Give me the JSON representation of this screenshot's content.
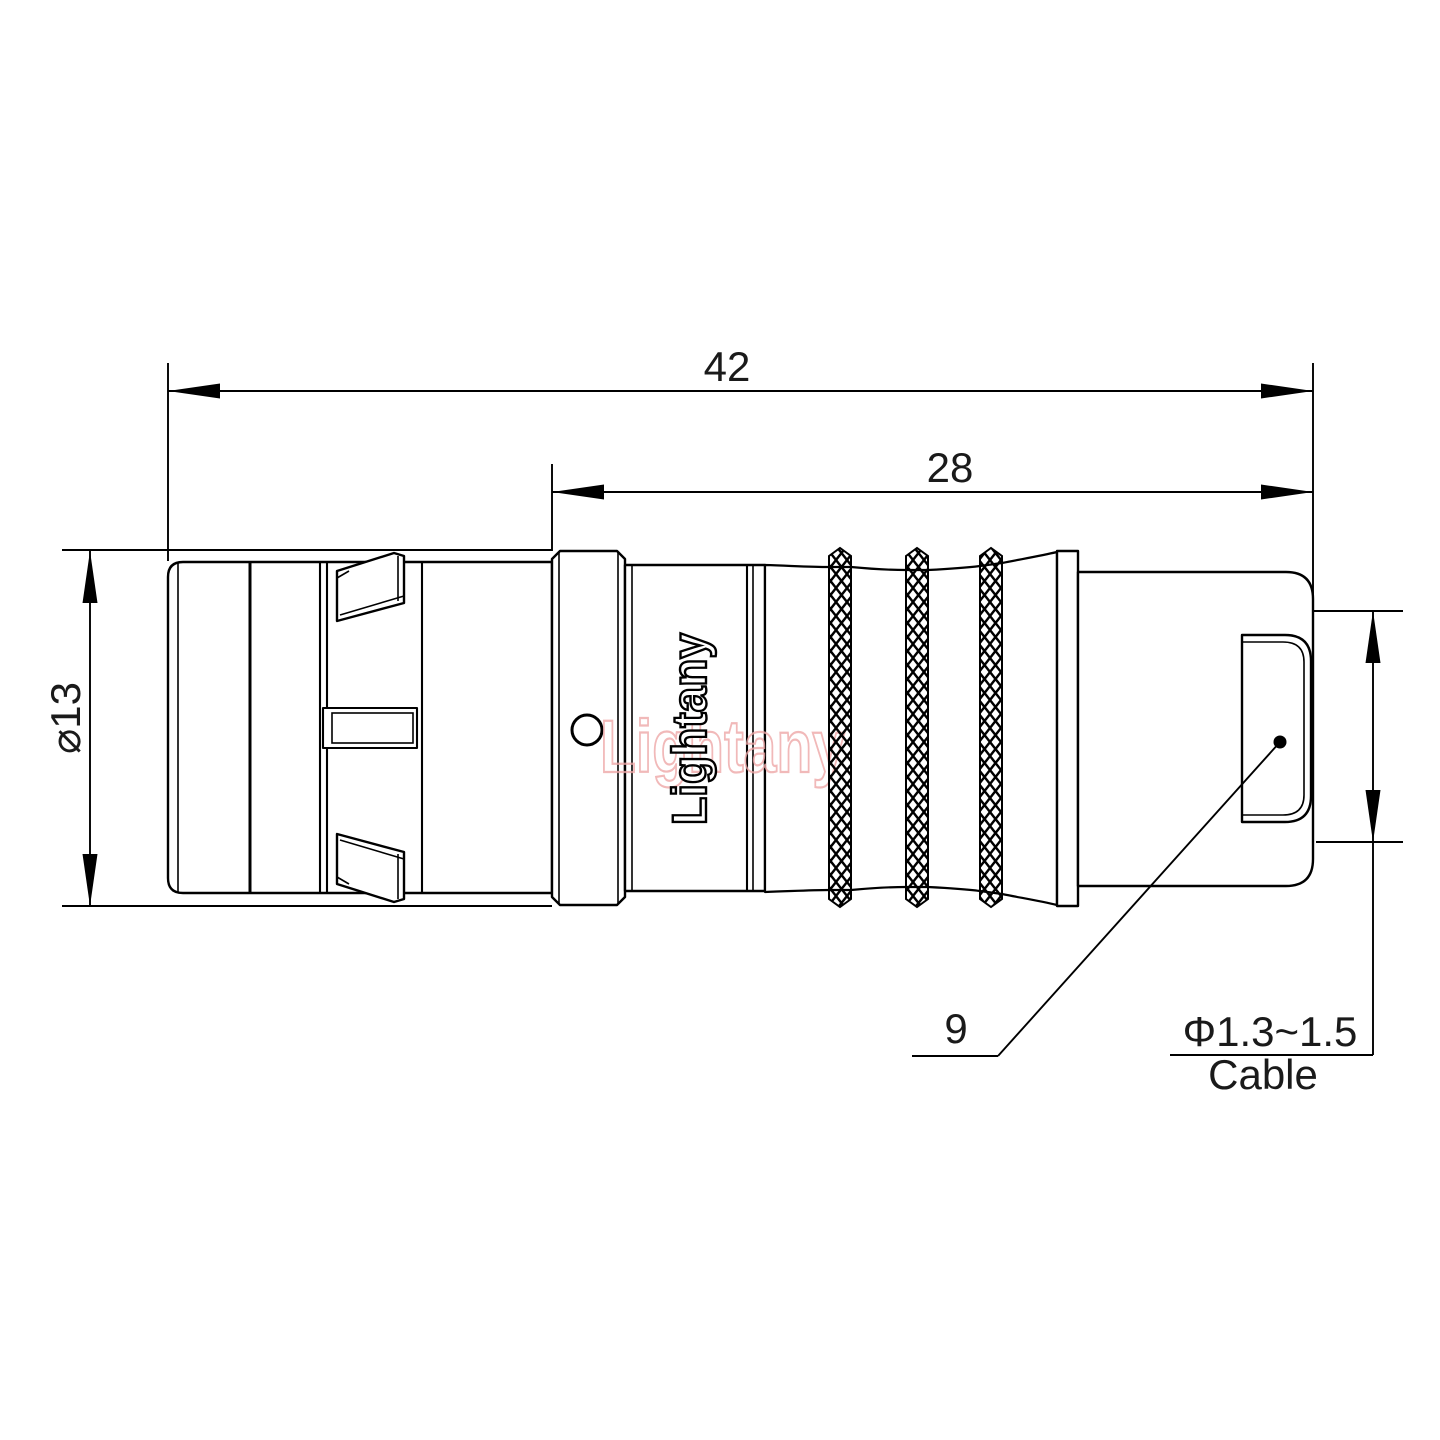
{
  "drawing": {
    "watermark": {
      "text": "Lightany"
    },
    "logo": {
      "text": "Lightany"
    }
  },
  "dimensions": {
    "overall_length": "42",
    "rear_length": "28",
    "diameter": "⌀13",
    "connector_size": "9",
    "cable_diameter": "Φ1.3~1.5",
    "cable_label": "Cable"
  },
  "colors": {
    "line": "#000000",
    "watermark": "#eea8a8",
    "background": "#ffffff"
  }
}
